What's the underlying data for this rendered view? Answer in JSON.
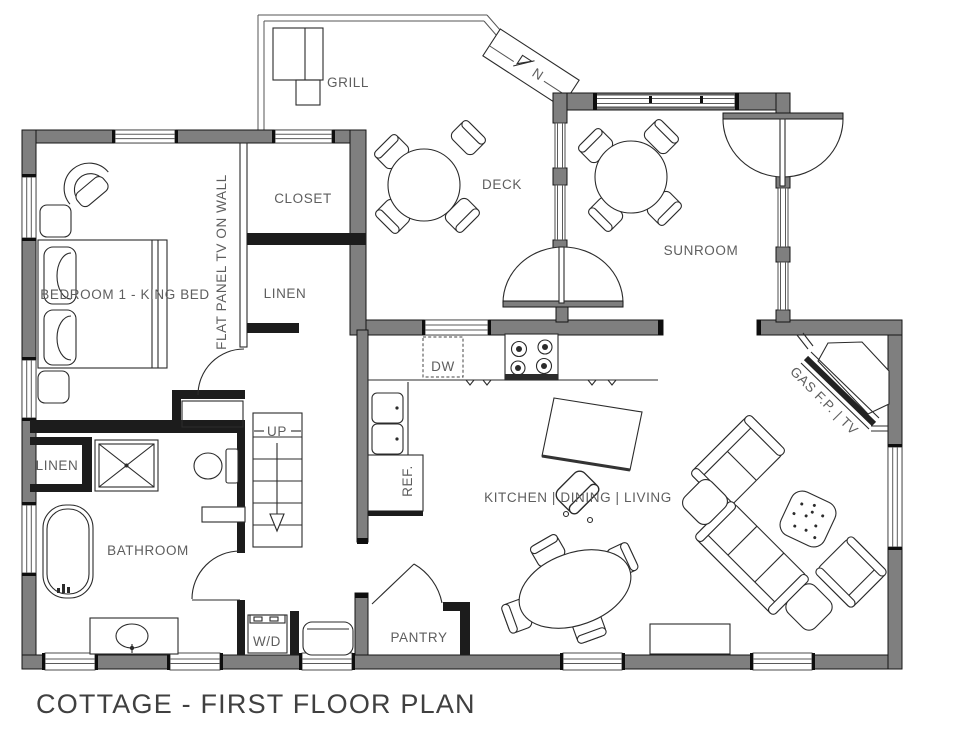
{
  "title": "COTTAGE - FIRST FLOOR PLAN",
  "labels": {
    "grill": "GRILL",
    "deck": "DECK",
    "closet": "CLOSET",
    "sunroom": "SUNROOM",
    "bedroom": "BEDROOM 1 - KING BED",
    "tv_wall": "FLAT PANEL TV ON WALL",
    "linen_hall": "LINEN",
    "linen_bath": "LINEN",
    "up": "UP",
    "bathroom": "BATHROOM",
    "wd": "W/D",
    "pantry": "PANTRY",
    "kitchen": "KITCHEN | DINING | LIVING",
    "gas_fp": "GAS F.P. | TV",
    "north": "N",
    "dw": "DW",
    "ref": "REF."
  },
  "colors": {
    "background": "#ffffff",
    "exterior_wall": "#7f7f7f",
    "interior_wall": "#1c1c1c",
    "line": "#2b2b2b",
    "label": "#5e5e5e",
    "title": "#404040"
  }
}
